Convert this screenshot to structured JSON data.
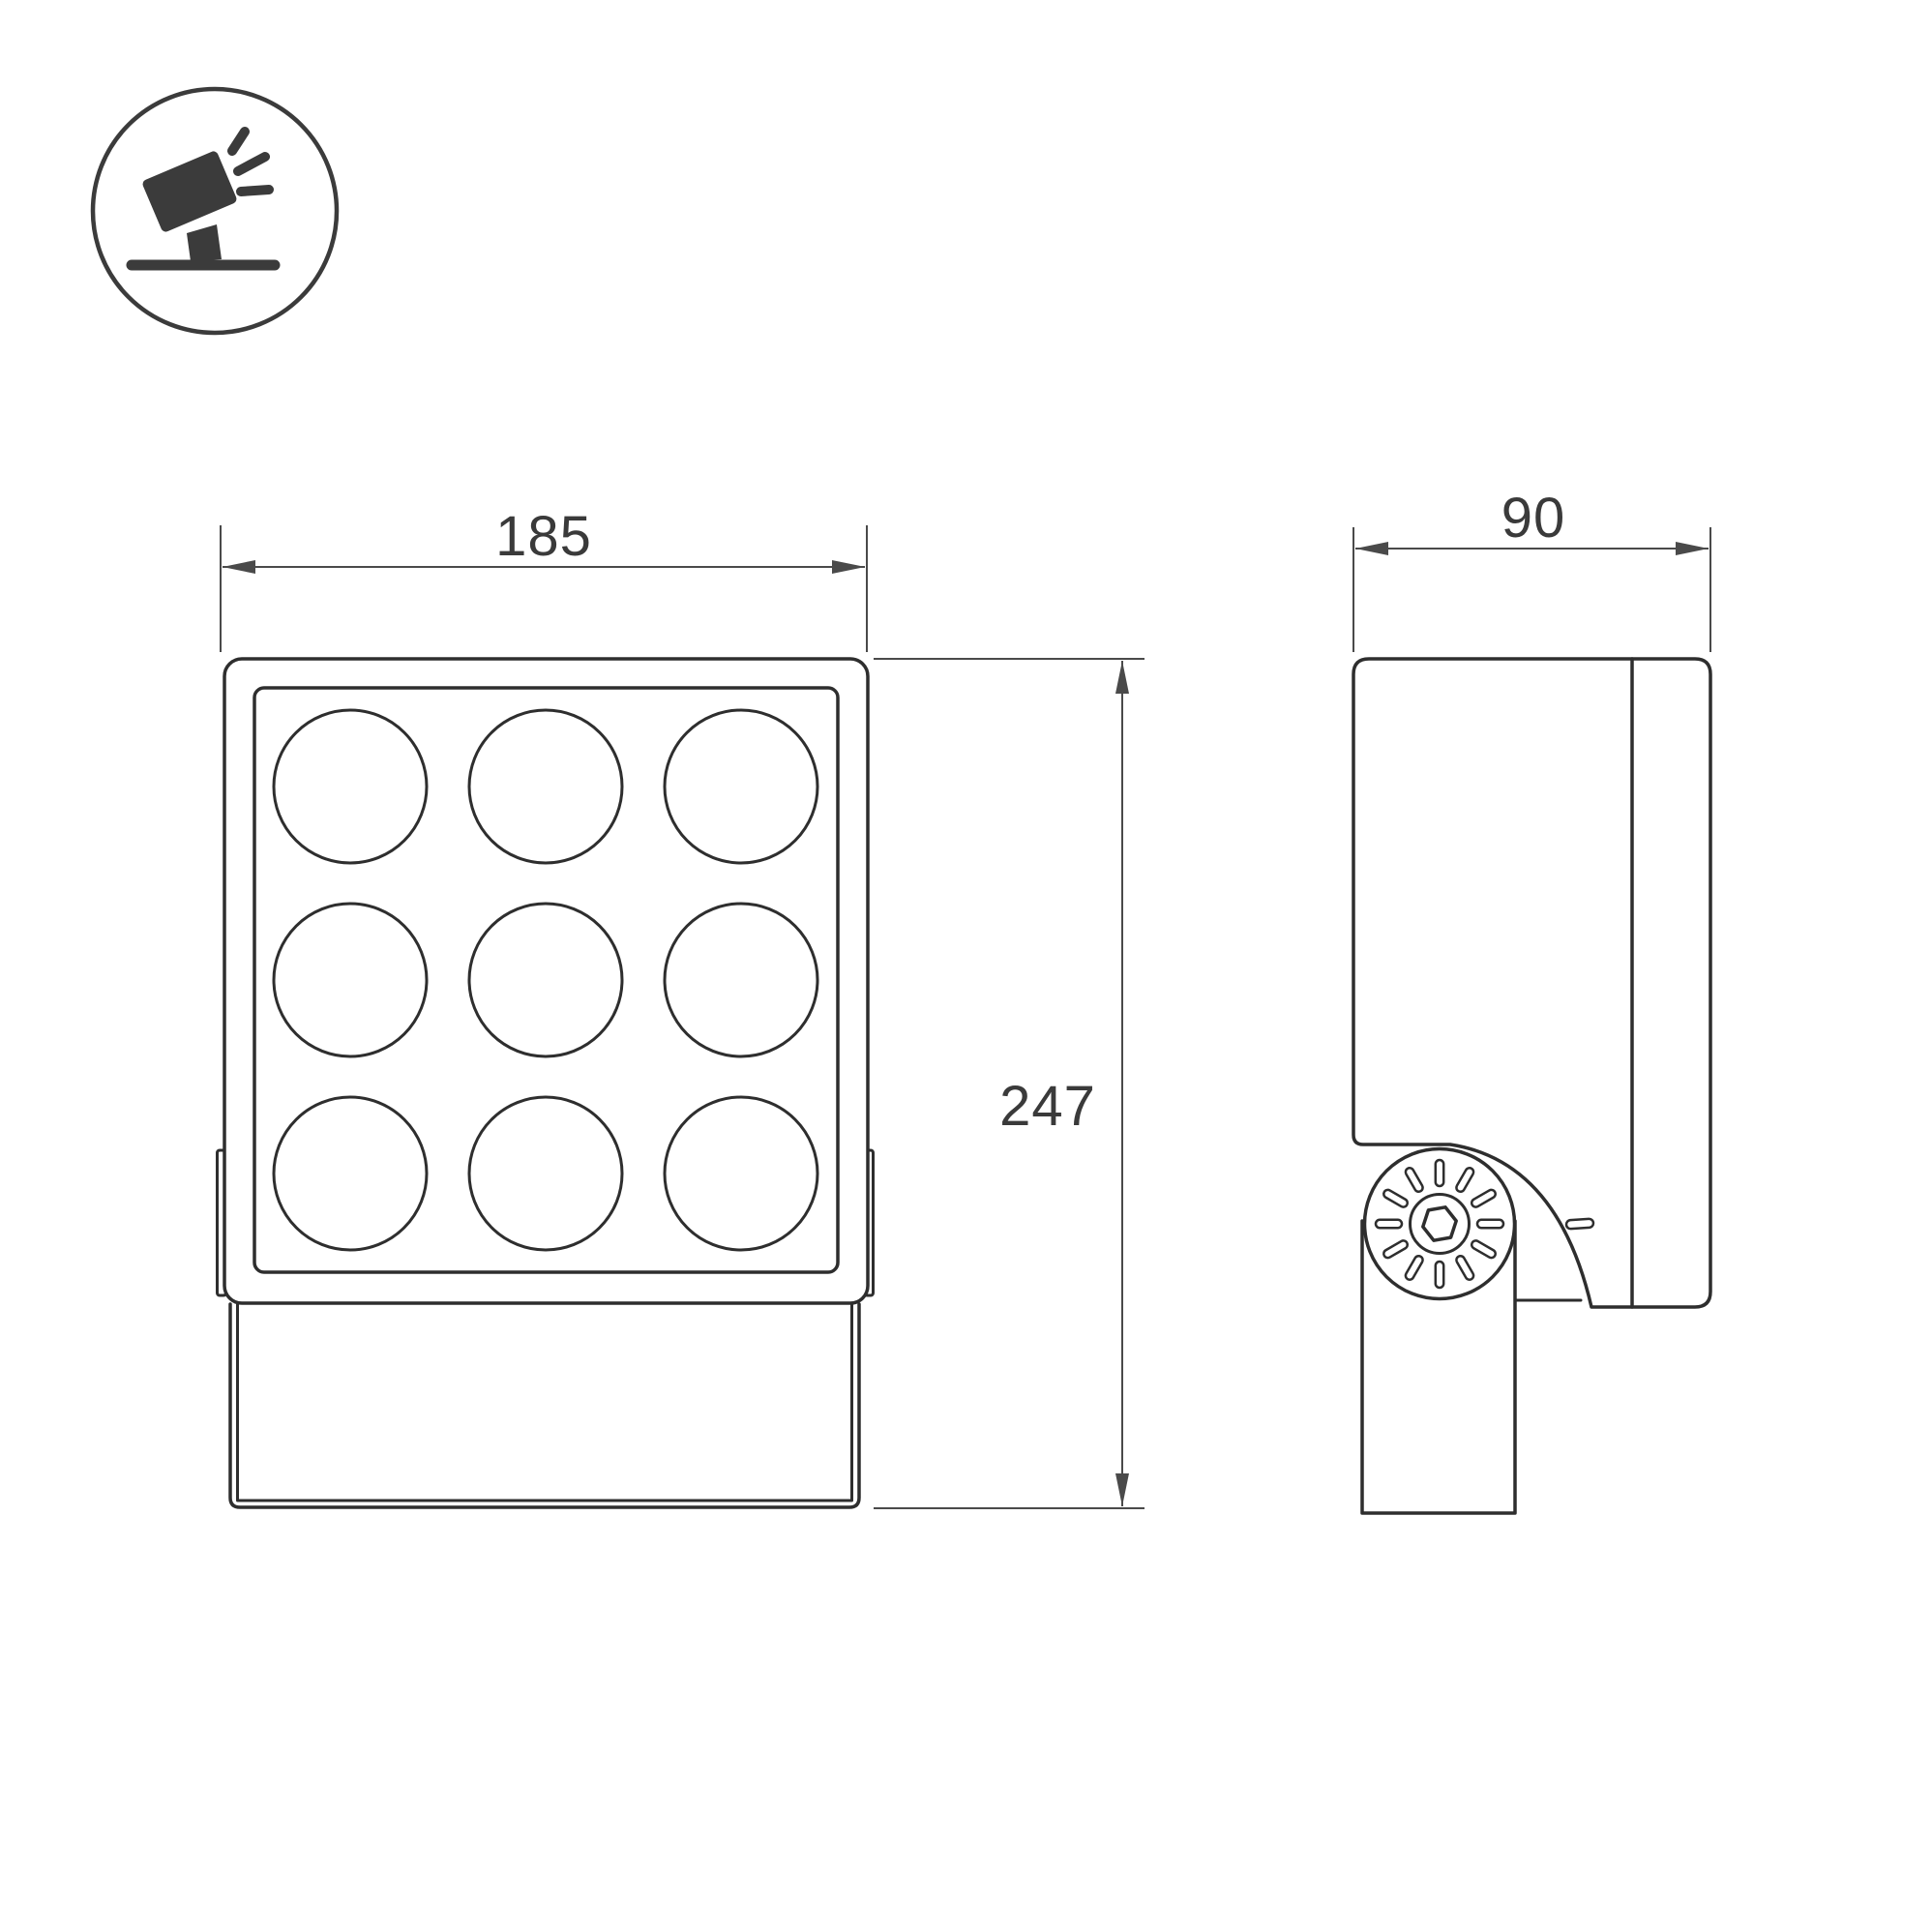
{
  "title": "LED floodlight dimension drawing",
  "colors": {
    "line": "#2e2e2e",
    "dim_line": "#4a4a4a",
    "text": "#3a3a3a",
    "icon": "#3b3b3b",
    "background": "#ffffff"
  },
  "icons": {
    "product_type": "tilted-floodlight-on-surface-icon"
  },
  "dimensions": {
    "width_label": "185",
    "depth_label": "90",
    "height_label": "247"
  },
  "front_view": {
    "lens_rows": 3,
    "lens_cols": 3,
    "lens_count": 9
  },
  "side_view": {
    "knob_tick_count": 12,
    "has_hex_socket_screw": true
  }
}
